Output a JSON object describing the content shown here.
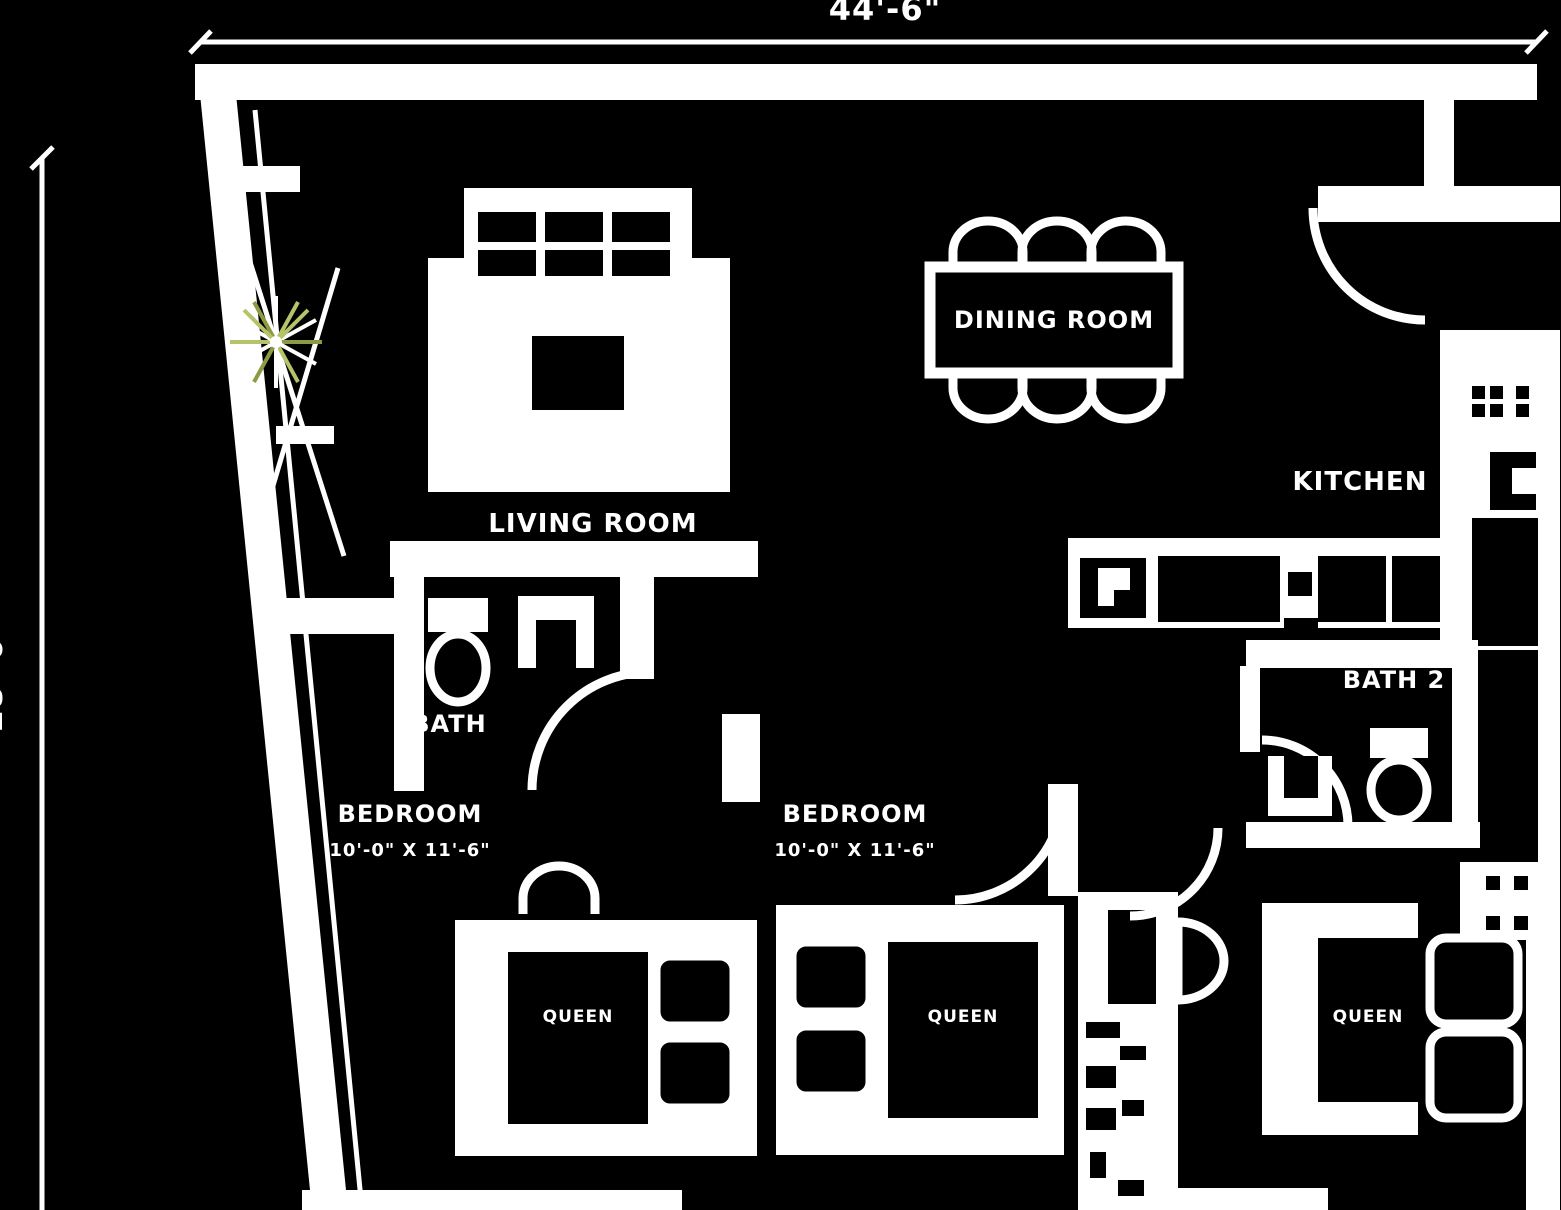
{
  "plan": {
    "dimensions": {
      "top": "44'-6\"",
      "left": "28'-0\""
    },
    "rooms": {
      "living": "LIVING ROOM",
      "dining": "DINING ROOM",
      "kitchen": "KITCHEN",
      "bath1": "BATH",
      "bath2": "BATH 2",
      "bedroom1": "BEDROOM",
      "bedroom1_size": "10'-0\" X 11'-6\"",
      "bedroom2": "BEDROOM",
      "bedroom2_size": "10'-0\" X 11'-6\""
    },
    "beds": {
      "bed1": "QUEEN",
      "bed2": "QUEEN",
      "bed3": "QUEEN"
    },
    "colors": {
      "background": "#000000",
      "lines": "#ffffff",
      "plant_accent": "#b7c36a",
      "plant_accent_dark": "#8e9a43"
    }
  }
}
